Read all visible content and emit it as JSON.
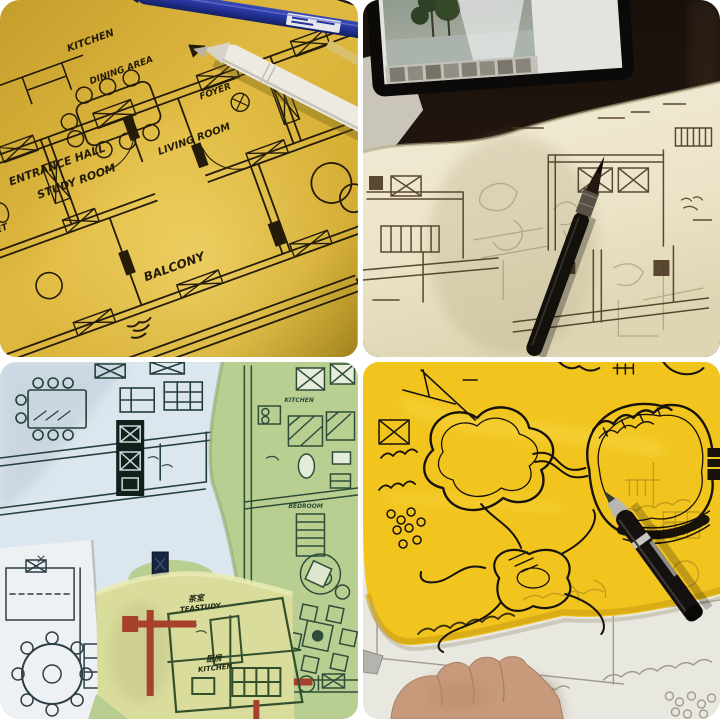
{
  "collage": {
    "background_color": "#ffffff",
    "quadrants": {
      "top_left": {
        "alt": "Apartment floor plan drawn in black ink on yellow tracing paper, blue pen and white marker lying on top",
        "labels": {
          "kitchen": "KITCHEN",
          "dining_area": "DINING AREA",
          "foyer": "FOYER",
          "toilet": "TOILET",
          "entrance_hall": "ENTRANCE HALL",
          "study_room": "STUDY ROOM",
          "living_room": "LIVING ROOM",
          "balcony": "BALCONY"
        },
        "colors": {
          "paper": "#d9af30",
          "ink": "#241c08",
          "pen_blue": "#2a3a9c",
          "marker_white": "#eceadf"
        }
      },
      "top_right": {
        "alt": "Freehand plan sketch in sepia ink on cream tracing paper on a dark desk, tablet with reference photo above, brush pen on the paper",
        "colors": {
          "desk": "#1c120b",
          "paper": "#efe8d0",
          "ink": "#54412b"
        }
      },
      "bottom_left": {
        "alt": "Overlapping floor plan drawings on pale blue, green and yellow sheets with red walls and bilingual room labels",
        "labels": {
          "tea_study_cn": "茶室",
          "tea_study_en": "TEASTUDY",
          "kitchen_cn": "厨房",
          "kitchen_en": "KITCHEN",
          "green_kitchen": "KITCHEN",
          "green_bedroom": "BEDROOM"
        },
        "colors": {
          "paper_blue": "#dce6ee",
          "paper_green": "#b9cf92",
          "paper_yellow": "#d9dc9b",
          "wall_red": "#a8402e",
          "ink": "#2e4a3c"
        }
      },
      "bottom_right": {
        "alt": "Landscape site plan with organic pond shapes in black marker on bright yellow tracing paper over a printed base plan, marker pen and hand visible",
        "colors": {
          "paper_yellow": "#f2c51e",
          "ink": "#17120a",
          "base_paper": "#e9e8e0"
        }
      }
    }
  }
}
